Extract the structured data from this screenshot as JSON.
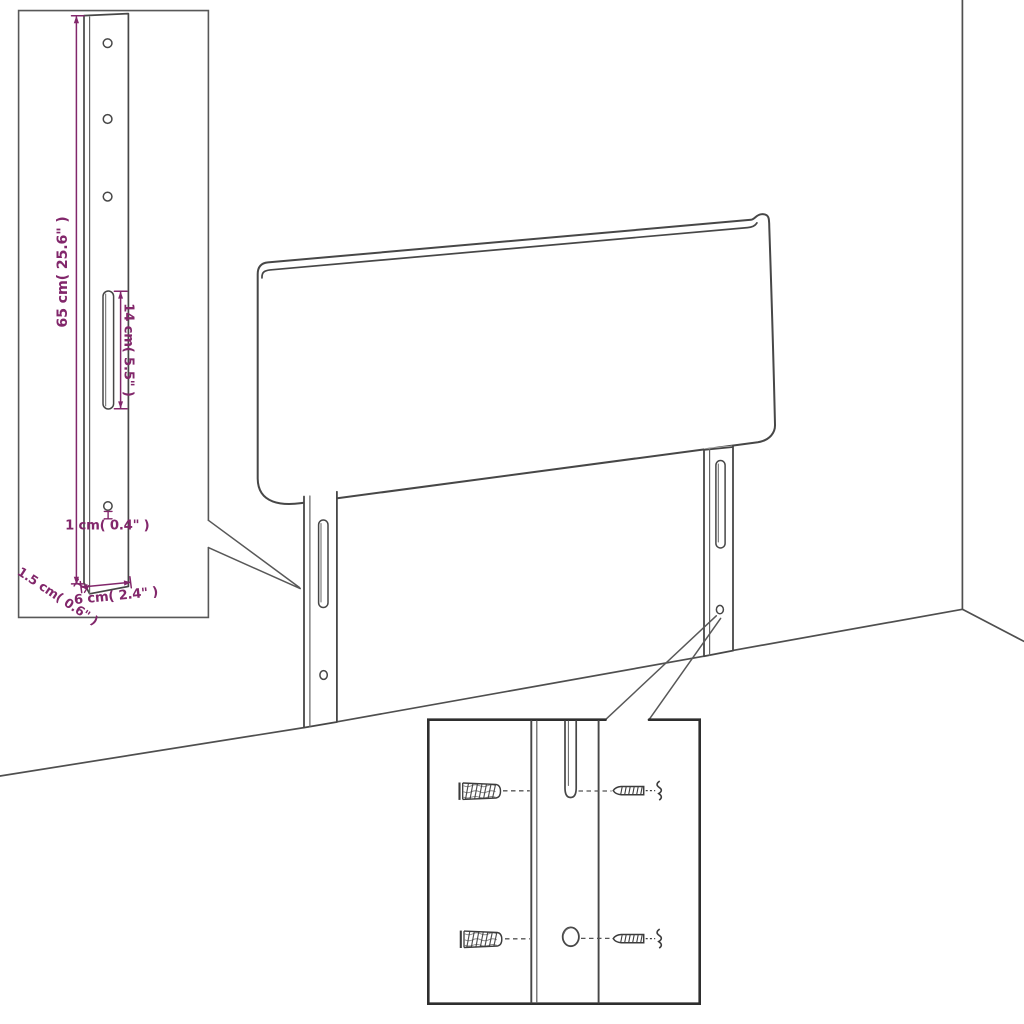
{
  "diagram": {
    "type": "headboard-assembly-dimension-diagram",
    "dimension_labels": {
      "bracket_height": "65 cm( 25.6\" )",
      "slot_length": "14 cm( 5.5\" )",
      "hole_diameter": "1 cm( 0.4\" )",
      "bracket_thickness": "1.5 cm( 0.6\" )",
      "bracket_width": "6 cm( 2.4\" )"
    },
    "colors": {
      "background": "#ffffff",
      "drawing_line": "#474747",
      "room_line": "#4f4f4f",
      "detail_inset_border": "#585858",
      "hardware_inset_border": "#2e2e2e",
      "dimension_text": "#82276B"
    },
    "icons": {
      "wall_plug": "hatched-cylinder-anchor",
      "screw": "pointed-threaded-screw",
      "spring_washer": "vertical-squiggle"
    }
  }
}
